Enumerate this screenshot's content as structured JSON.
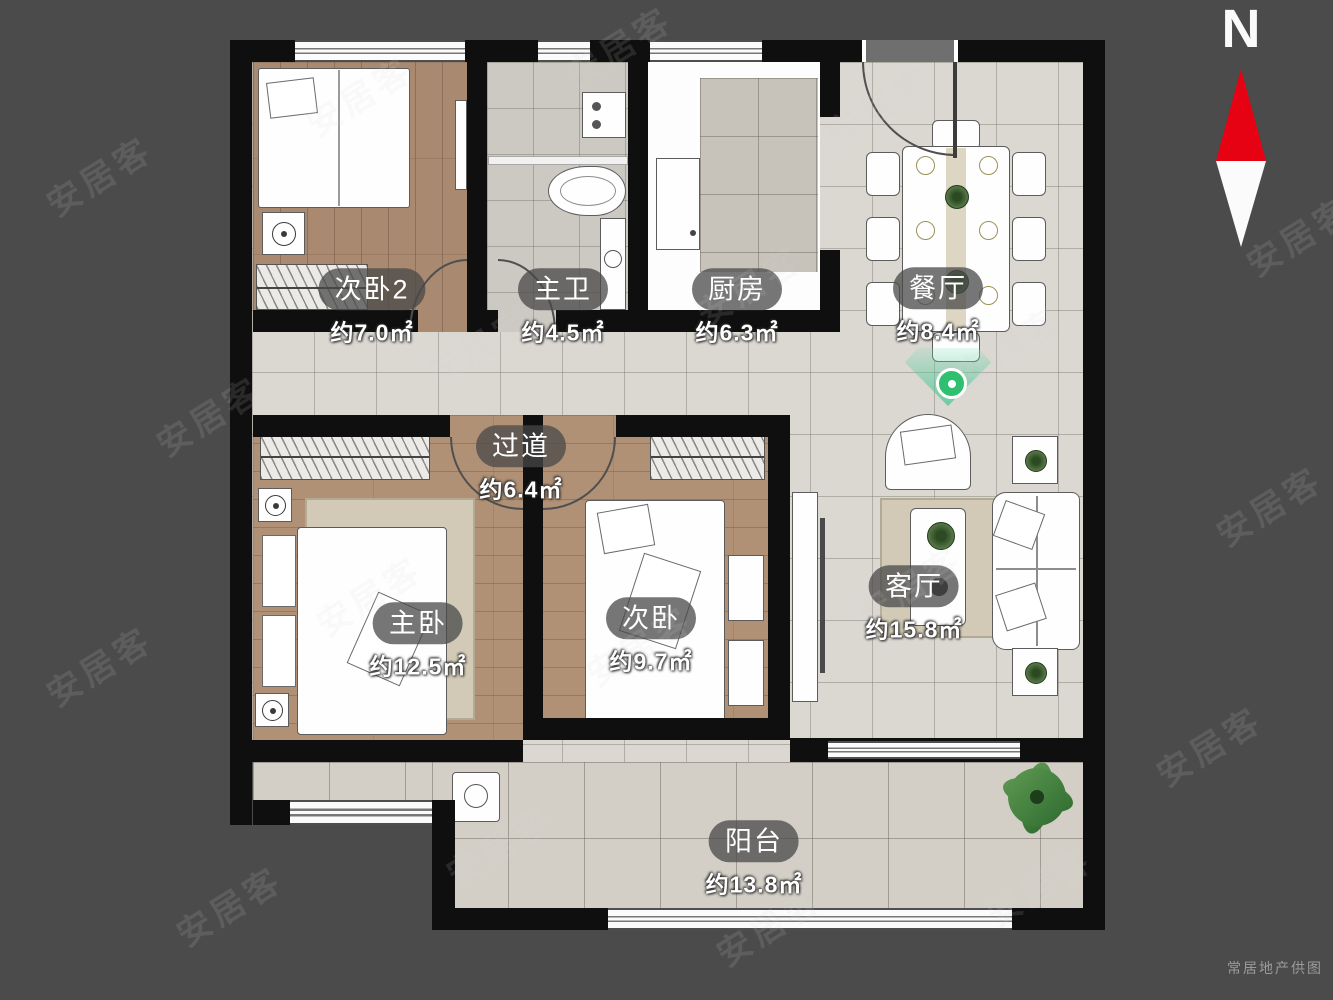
{
  "compass": {
    "label": "N"
  },
  "watermark": {
    "text": "安居客"
  },
  "credit": {
    "text": "常居地产供图"
  },
  "rooms": [
    {
      "id": "bedroom2",
      "name": "次卧2",
      "area": "约7.0㎡"
    },
    {
      "id": "bathroom",
      "name": "主卫",
      "area": "约4.5㎡"
    },
    {
      "id": "kitchen",
      "name": "厨房",
      "area": "约6.3㎡"
    },
    {
      "id": "dining",
      "name": "餐厅",
      "area": "约8.4㎡"
    },
    {
      "id": "hallway",
      "name": "过道",
      "area": "约6.4㎡"
    },
    {
      "id": "master",
      "name": "主卧",
      "area": "约12.5㎡"
    },
    {
      "id": "bedroom",
      "name": "次卧",
      "area": "约9.7㎡"
    },
    {
      "id": "living",
      "name": "客厅",
      "area": "约15.8㎡"
    },
    {
      "id": "balcony",
      "name": "阳台",
      "area": "约13.8㎡"
    }
  ],
  "colors": {
    "background": "#4b4b4b",
    "wall": "#0f0f0f",
    "wood_floor": "#ac8d74",
    "tile_floor": "#dbd7d1",
    "compass_red": "#e60113",
    "marker_green": "#2ec06e",
    "label_pill": "rgba(72,72,72,0.75)"
  }
}
